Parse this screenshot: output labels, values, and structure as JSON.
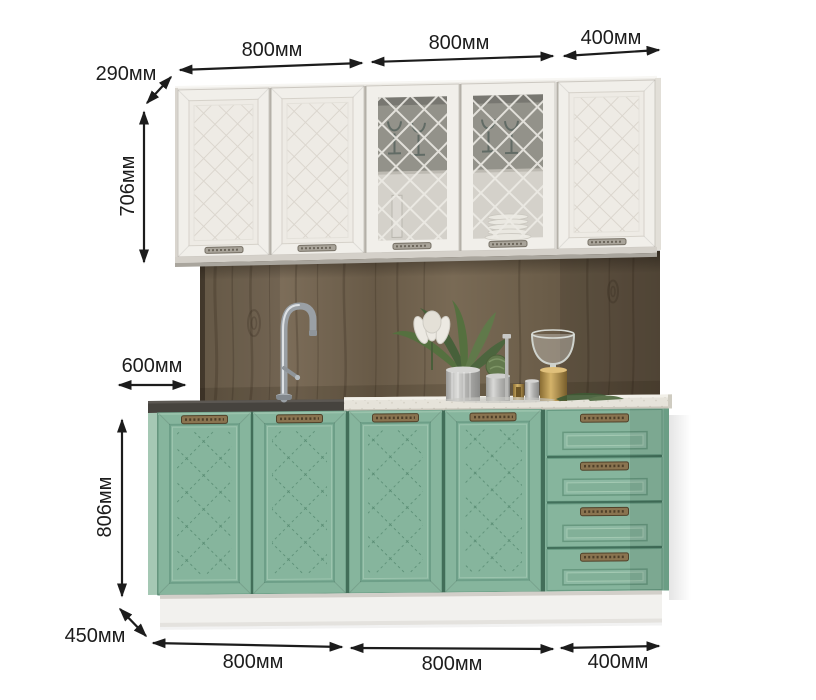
{
  "colors": {
    "background": "#ffffff",
    "dim_text": "#1c1c1c",
    "wall_white": "#f1efea",
    "base_green": "#86b59d",
    "wood_brown": "#6e604d",
    "counter_light": "#e6e3da",
    "counter_dark": "#46433e",
    "plinth_white": "#f2f1ee",
    "handle_silver": "#a9a49a",
    "handle_bronze": "#8a7450"
  },
  "dimensions": {
    "top": [
      {
        "label": "800мм"
      },
      {
        "label": "800мм"
      },
      {
        "label": "400мм"
      }
    ],
    "wall_depth": {
      "label": "290мм"
    },
    "wall_height": {
      "label": "706мм"
    },
    "base_depth_top": {
      "label": "600мм"
    },
    "base_height": {
      "label": "806мм"
    },
    "base_depth_bottom": {
      "label": "450мм"
    },
    "bottom": [
      {
        "label": "800мм"
      },
      {
        "label": "800мм"
      },
      {
        "label": "400мм"
      }
    ]
  }
}
